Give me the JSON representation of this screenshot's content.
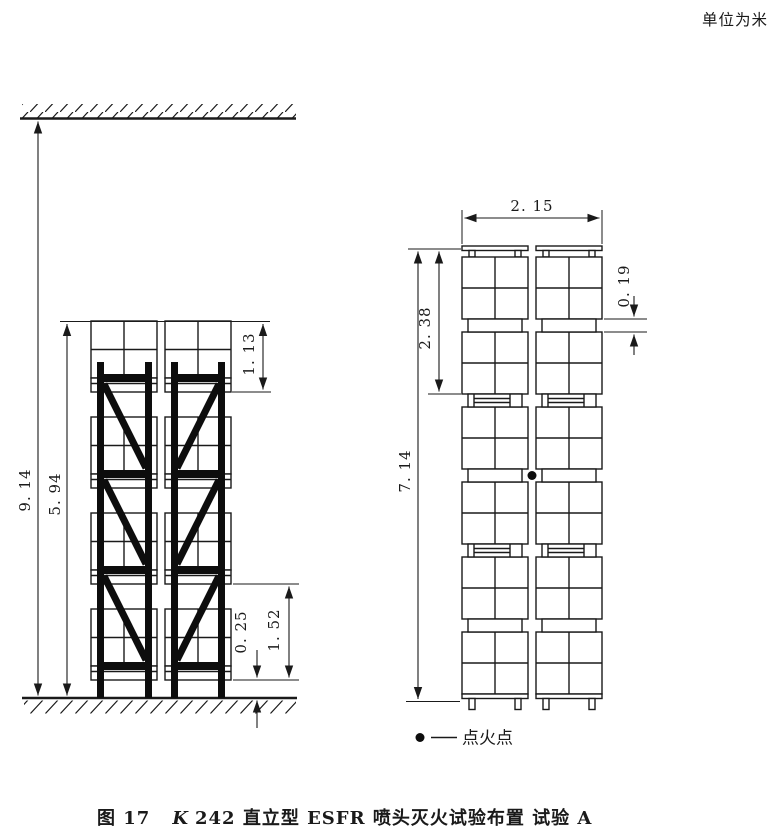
{
  "units_note": "单位为米",
  "caption": {
    "figure_label": "图 17",
    "variable": "K",
    "rest": "242 直立型 ESFR 喷头灭火试验布置 试验 A"
  },
  "legend": {
    "label": "点火点"
  },
  "left_view": {
    "description_name": "rack-elevation-view",
    "dims": {
      "ceiling_height": "9. 14",
      "storage_height": "5. 94",
      "top_tier_height": "1. 13",
      "tier_pitch": "1. 52",
      "base_clearance": "0. 25"
    }
  },
  "right_view": {
    "description_name": "pallet-stack-view",
    "dims": {
      "stack_width": "2. 15",
      "module_height": "2. 38",
      "stack_height": "7. 14",
      "pallet_height": "0. 19"
    }
  },
  "colors": {
    "ink": "#1a1a1a",
    "paper": "#ffffff"
  }
}
